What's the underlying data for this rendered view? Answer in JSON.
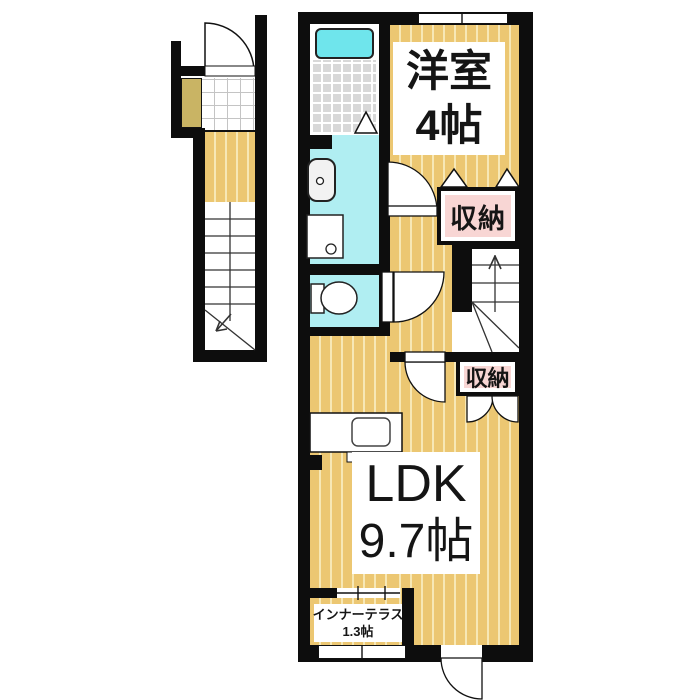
{
  "floorplan": {
    "rooms": {
      "western_room": {
        "name": "洋室",
        "size": "4帖"
      },
      "ldk": {
        "name": "LDK",
        "size": "9.7帖"
      },
      "inner_terrace": {
        "name": "インナーテラス",
        "size": "1.3帖"
      },
      "storage_upper": {
        "name": "収納"
      },
      "storage_lower": {
        "name": "収納"
      }
    },
    "colors": {
      "wall": "#0d0d0d",
      "wood_floor": "#ecc772",
      "wood_floor_stripe": "#f7e8b6",
      "water_area": "#b0eef2",
      "bathtub": "#6fe5ec",
      "bath_tile": "#d8d8d8",
      "closet_label_bg": "#f8d6d4",
      "shoe_cabinet": "#c9b464"
    }
  }
}
